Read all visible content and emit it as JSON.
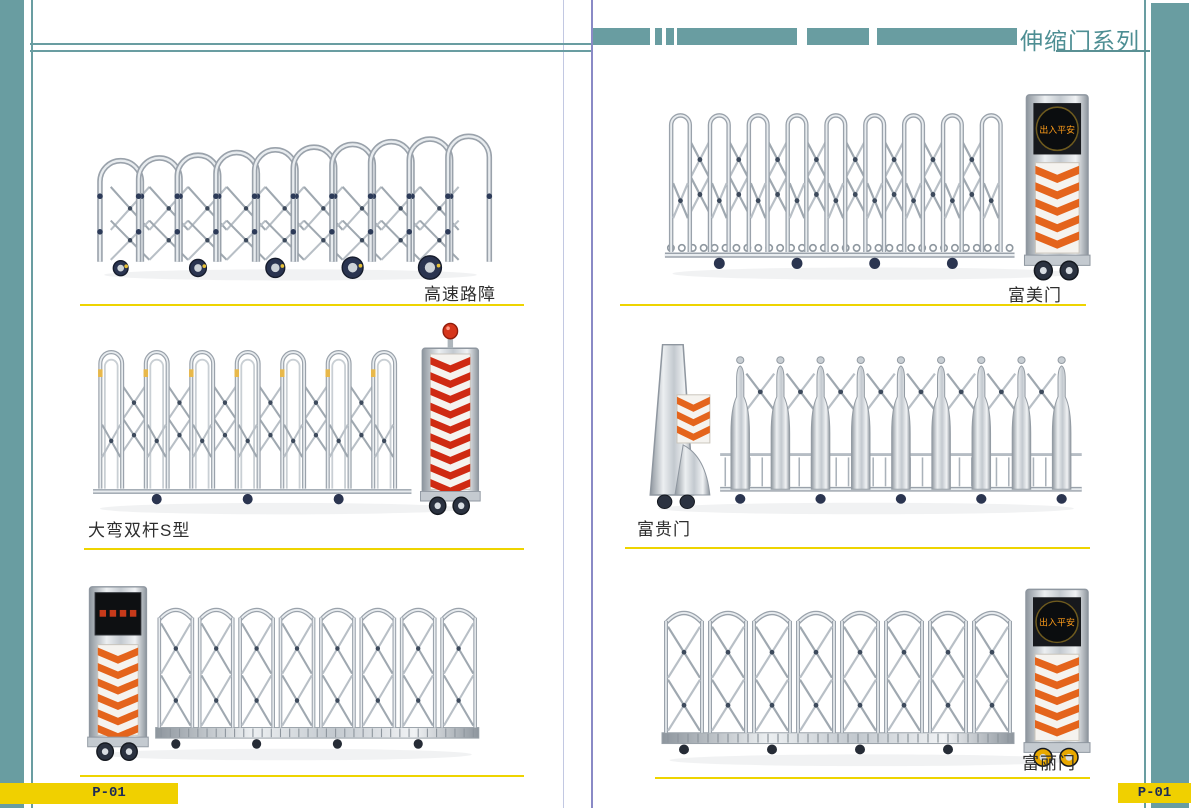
{
  "page": {
    "series_title": "伸缩门系列",
    "page_number_left": "P-01",
    "page_number_right": "P-01"
  },
  "colors": {
    "teal": "#699da1",
    "title_teal": "#4d8e93",
    "divider_purple": "#8a8ac6",
    "separator_yellow": "#eed400",
    "badge_yellow": "#f0d000",
    "badge_text_navy": "#1c2b57",
    "caption_dark": "#2e2e2e",
    "chevron_red": "#cf2a12",
    "chevron_orange": "#e4641c",
    "beacon_red": "#d6361c",
    "led_amber": "#ff9d1a",
    "led_red": "#e8421c",
    "wheel_navy": "#2b3240",
    "wheel_yellow": "#e8a800",
    "metal_silver": "#bcc3c9"
  },
  "products": [
    {
      "label": "高速路障",
      "caption_side": "right",
      "figure": {
        "style": "barrier",
        "panels": 10,
        "drive": null,
        "wheel_color": "dark"
      }
    },
    {
      "label": "大弯双杆S型",
      "caption_side": "left",
      "figure": {
        "style": "arch",
        "panels": 7,
        "tall": true,
        "drive": "right",
        "drive_variant": "box",
        "beacon": true,
        "led": "",
        "led_text": "",
        "chevron": "#cf2a12",
        "wheel_color": "dark"
      }
    },
    {
      "label": "",
      "caption_side": "none",
      "figure": {
        "style": "xframe",
        "panels": 8,
        "drive": "left",
        "drive_variant": "box",
        "led": "rect",
        "led_text": "",
        "chevron": "#e4641c",
        "wheel_color": "dark"
      }
    },
    {
      "label": "富美门",
      "caption_side": "right",
      "figure": {
        "style": "arch",
        "panels": 9,
        "chain": true,
        "drive": "right",
        "drive_variant": "box",
        "led": "disc",
        "led_text": "出入平安",
        "chevron": "#e4641c",
        "wheel_color": "dark"
      }
    },
    {
      "label": "富贵门",
      "caption_side": "left",
      "figure": {
        "style": "bottle",
        "panels": 9,
        "drive": "left",
        "drive_variant": "taper",
        "led": "",
        "led_text": "",
        "chevron": "#e4641c",
        "wheel_color": "dark"
      }
    },
    {
      "label": "富丽门",
      "caption_side": "right",
      "figure": {
        "style": "xframe",
        "panels": 8,
        "drive": "right",
        "drive_variant": "box",
        "led": "disc",
        "led_text": "出入平安",
        "chevron": "#e4641c",
        "wheel_color": "yellow"
      }
    }
  ]
}
